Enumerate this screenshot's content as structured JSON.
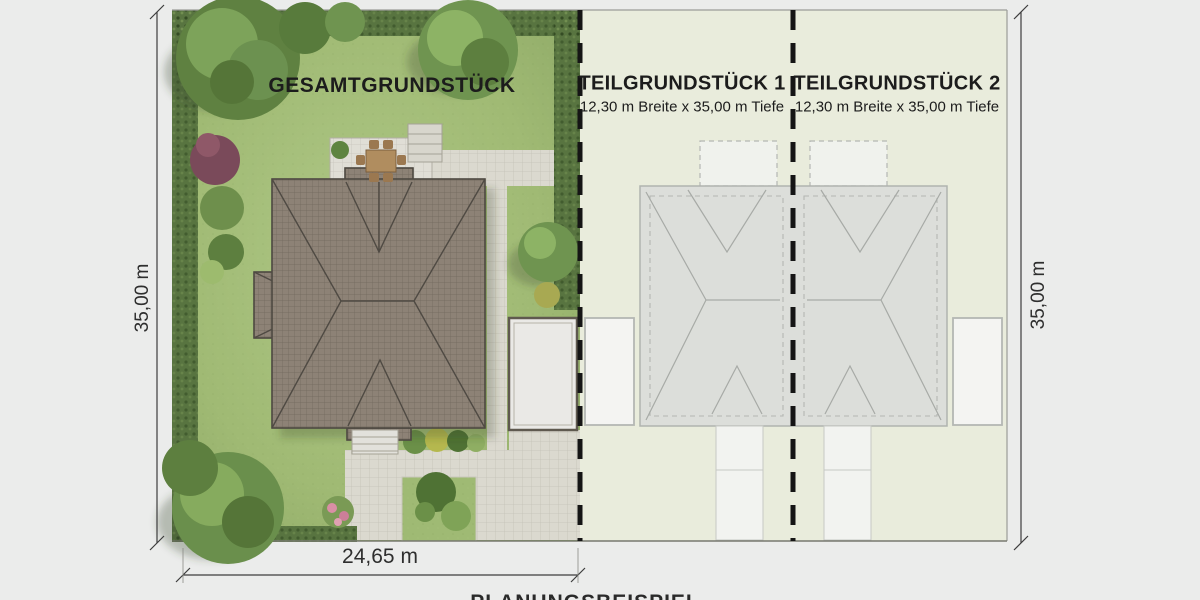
{
  "plan": {
    "total_plot": {
      "label": "GESAMTGRUNDSTÜCK"
    },
    "sub_plot_1": {
      "label": "TEILGRUNDSTÜCK 1",
      "size": "12,30 m Breite x 35,00 m Tiefe"
    },
    "sub_plot_2": {
      "label": "TEILGRUNDSTÜCK 2",
      "size": "12,30 m Breite x 35,00 m Tiefe"
    },
    "dimensions": {
      "left": "35,00 m",
      "right": "35,00 m",
      "bottom": "24,65 m",
      "bottom_caption_partial": "PLANUNGSBEISPIEL"
    },
    "colors": {
      "page_background": "#ebeceb",
      "lawn": "#a3bd78",
      "hedge": "#587440",
      "roof": "#8d8276",
      "pale_plots": "#e9ecdc",
      "ghost_outline": "#a7aaa6",
      "divider": "#151515",
      "text": "#1c1c1c"
    }
  }
}
